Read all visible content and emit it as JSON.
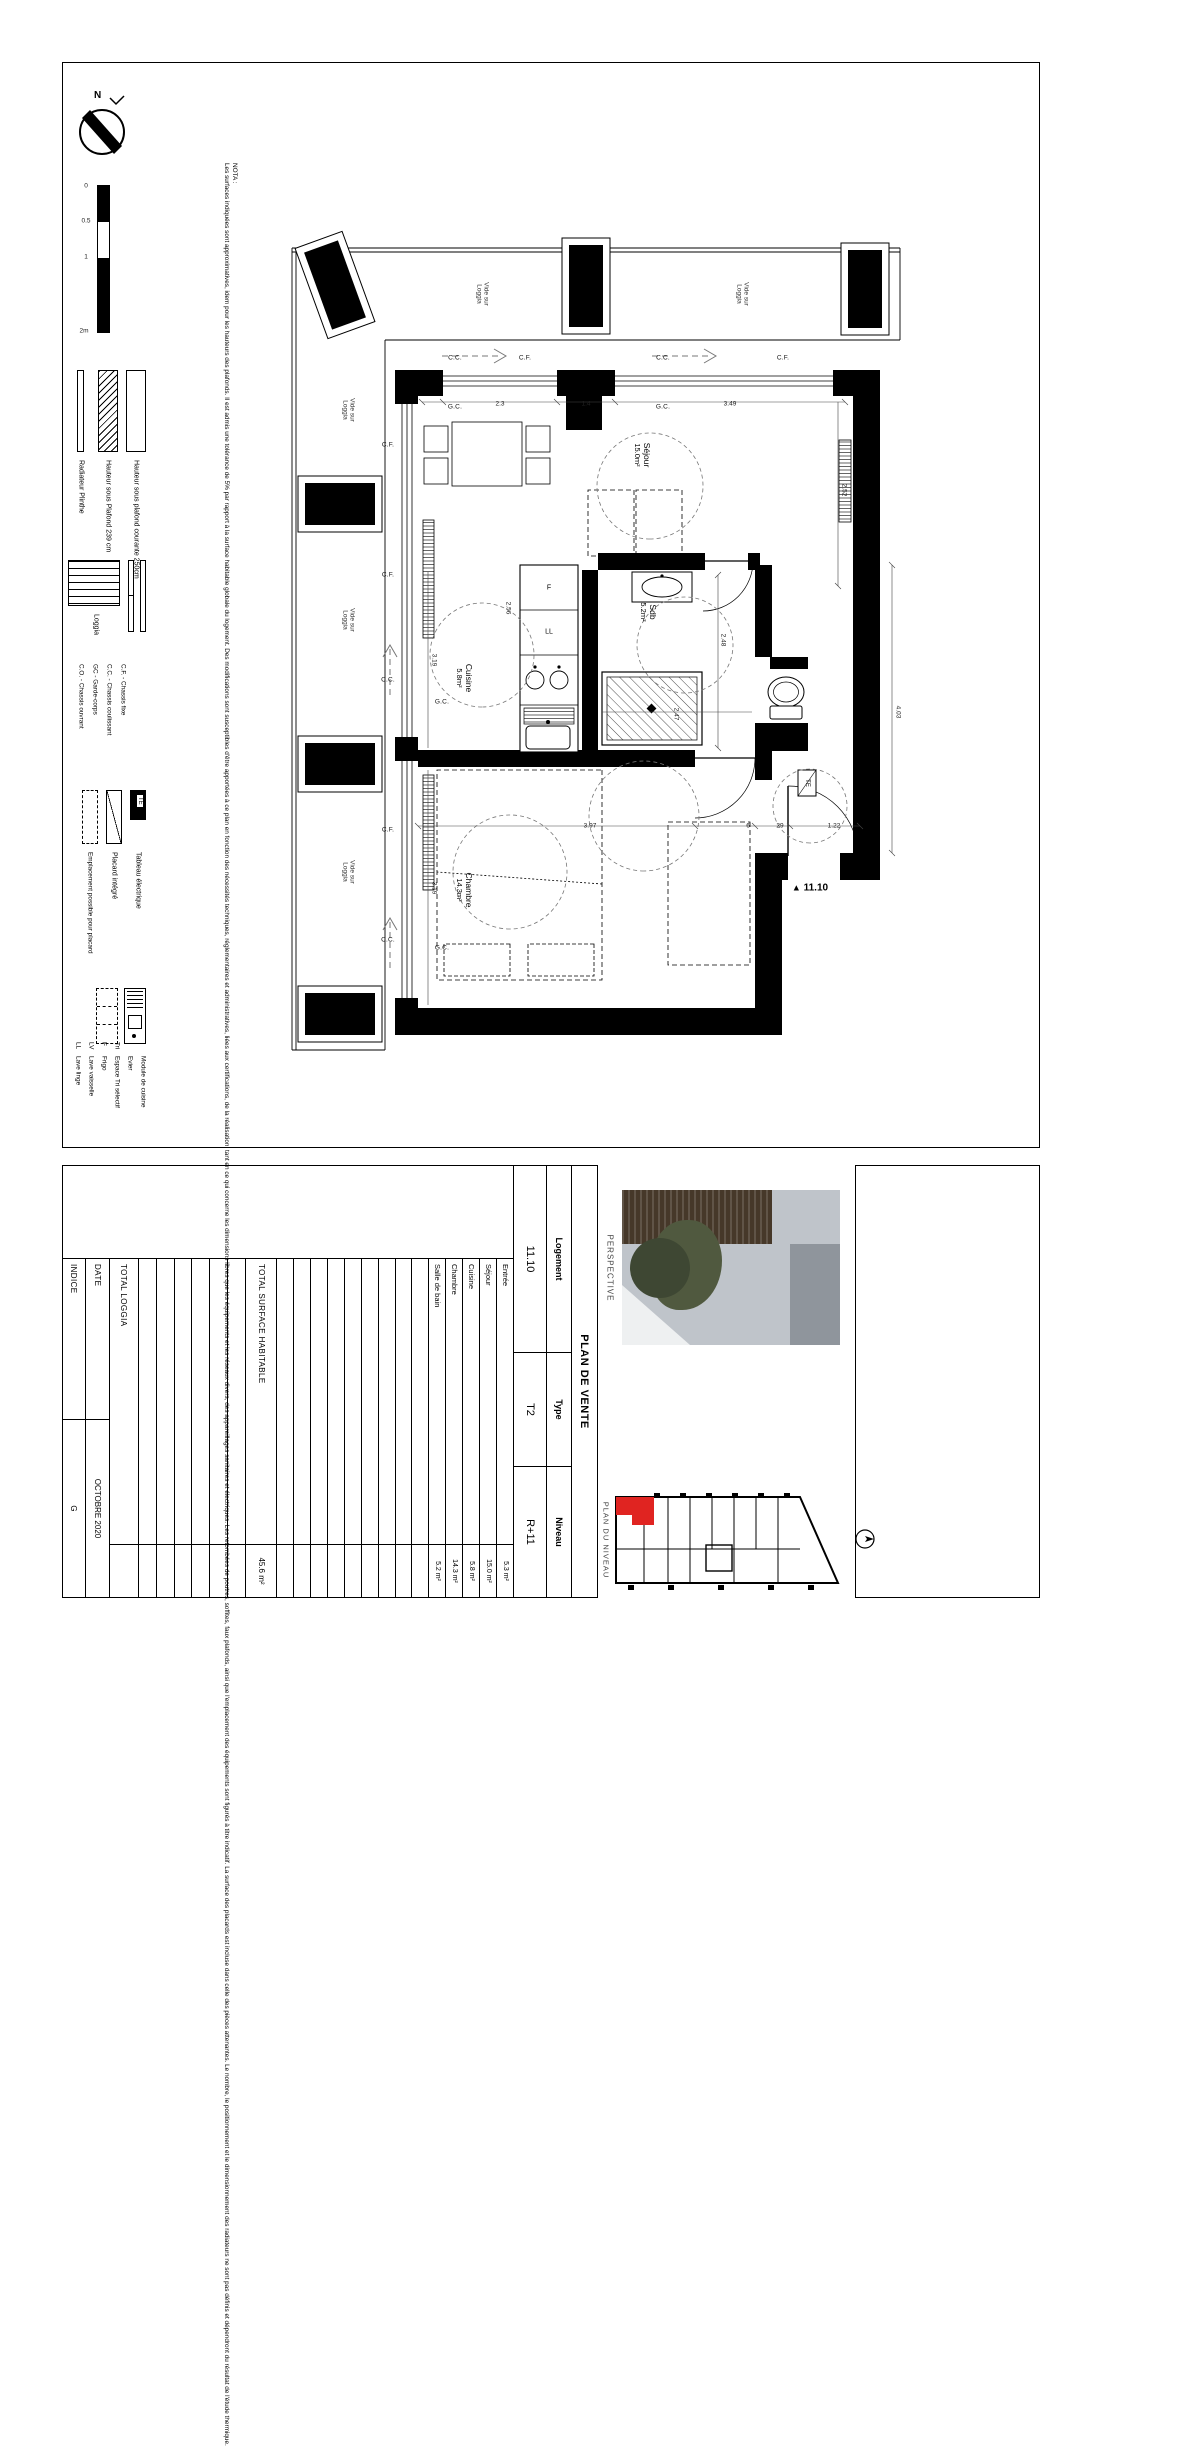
{
  "sheet": {
    "nota_title": "NOTA :",
    "nota_body": "Les surfaces indiquées sont approximatives, idem pour les hauteurs des plafonds. Il est admis une tolérance de 5% par rapport à la surface habitable globale du logement. Des modifications sont susceptibles d'être apportées à ce plan en fonction des nécessités techniques, réglementaires et administratives, liées aux certifications, de la réalisation, tant en ce qui concerne les dimensions libres que les équipements et les réseaux divers, des appareillages sanitaires et électriques. Les retombées de poutres, soffites, faux plafonds, ainsi que l'emplacement des équipements sont figurés à titre indicatif. La surface des placards est incluse dans celle des pièces attenantes. Le nombre, le positionnement et le dimensionnement des radiateurs ne sont pas définis et dépendront du résultat de l'étude thermique.",
    "compass_n": "N",
    "scale": {
      "t0": "0",
      "t1": "0.5",
      "t2": "1",
      "t3": "2m"
    },
    "legend": {
      "h250": "Hauteur sous plafond courante 250cm",
      "h239": "Hauteur sous Plafond 239 cm",
      "radiateur": "Radiateur Plinthe",
      "loggia": "Loggia",
      "abbr": [
        "C.F. - Chassis fixe",
        "C.C. - Chassis coulissant",
        "GC - Garde-corps",
        "C.O. - Chassis ouvrant"
      ],
      "te_symbol": "TE",
      "te": "Tableau électrique",
      "placard": "Placard intégré",
      "emplacement": "Emplacement possible pour placard",
      "kitchen": [
        {
          "abbr": "",
          "label": "Module de cuisine"
        },
        {
          "abbr": "",
          "label": "Evier"
        },
        {
          "abbr": "Tri",
          "label": "Espace Tri sélectif"
        },
        {
          "abbr": "F",
          "label": "Frigo"
        },
        {
          "abbr": "LV",
          "label": "Lave vaisselle"
        },
        {
          "abbr": "LL",
          "label": "Lave linge"
        }
      ]
    }
  },
  "plan": {
    "rooms": {
      "sejour": {
        "name": "Séjour",
        "area": "15.0m²"
      },
      "cuisine": {
        "name": "Cuisine",
        "area": "5.8m²"
      },
      "sdb": {
        "name": "Sdb",
        "area": "5.2m²"
      },
      "chambre": {
        "name": "Chambre",
        "area": "14.3m²"
      },
      "entree": {
        "name": "Entrée",
        "area": "5.3m²"
      }
    },
    "vide_sur_loggia": "Vide sur Loggia",
    "labels": {
      "cf": "C.F.",
      "cc": "C.C.",
      "gc": "G.C."
    },
    "te": "TE",
    "f": "F",
    "ll": "LL",
    "unit_marker": "11.10",
    "marker_icon": "▲",
    "dims": [
      "2.3",
      "1.4",
      "3.49",
      "2.52",
      "3.19",
      "2.56",
      "2.48",
      "2.47",
      "3.97",
      "6",
      "29",
      "1.22",
      "4.03",
      "3.19"
    ]
  },
  "titleblock": {
    "plan_de_vente": "PLAN DE VENTE",
    "logement_label": "Logement",
    "logement": "11.10",
    "type_label": "Type",
    "type": "T2",
    "niveau_label": "Niveau",
    "niveau": "R+11",
    "rooms": [
      {
        "label": "Entrée",
        "value": "5.3 m²"
      },
      {
        "label": "Séjour",
        "value": "15.0 m²"
      },
      {
        "label": "Cuisine",
        "value": "5.8 m²"
      },
      {
        "label": "Chambre",
        "value": "14.3 m²"
      },
      {
        "label": "Salle de bain",
        "value": "5.2 m²"
      }
    ],
    "total_surface_label": "TOTAL SURFACE HABITABLE",
    "total_surface": "45.6 m²",
    "total_loggia_label": "TOTAL LOGGIA",
    "total_loggia": "",
    "date_label": "DATE",
    "date": "OCTOBRE 2020",
    "indice_label": "INDICE",
    "indice": "G",
    "perspective": "PERSPECTIVE",
    "plan_du_niveau": "PLAN DU NIVEAU",
    "highlight": "#e02421"
  }
}
